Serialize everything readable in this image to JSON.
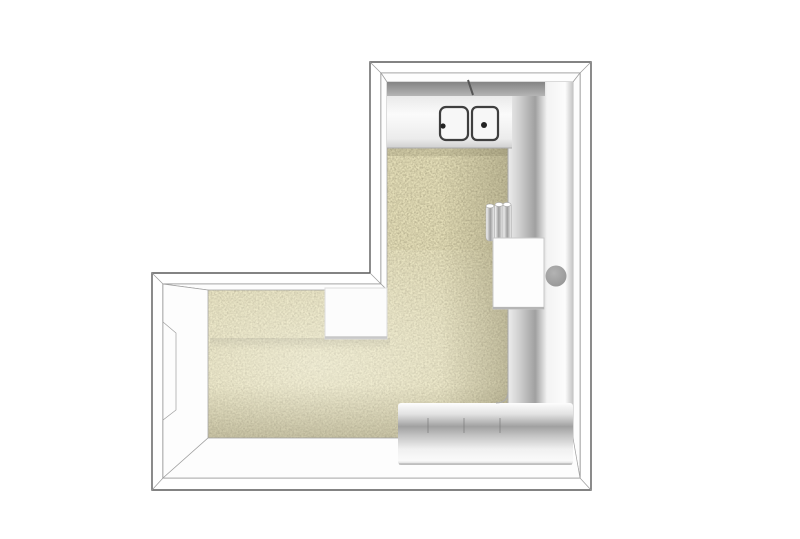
{
  "meta": {
    "type": "3d-floorplan-top-view",
    "description": "Top-down 3D rendering of an L-shaped kitchen floor plan with counters, double sink and appliances",
    "room_shape": "L-shaped",
    "text_content": "none"
  },
  "colors": {
    "background": "#ffffff",
    "wall_fill": "#ffffff",
    "wall_line": "#5a5a5a",
    "face_fill": "#fdfdfd",
    "floor_base": "#e4deb8",
    "floor_speckle": "#6f6850",
    "backsplash_dark": "#848484",
    "backsplash_light": "#b5b5b5",
    "counter_light": "#fbfbfb",
    "counter_mid": "#a0a0a0",
    "counter_edge": "#cfcfcf",
    "sink_fill": "#f7f7f7",
    "sink_line": "#3f3f3f",
    "drain_dot": "#222222",
    "appliance_fill": "#fdfdfd",
    "appliance_edge": "#c0c0c0",
    "knob_fill": "#939393",
    "table_fill": "#fcfcfc",
    "table_edge": "#cccccc",
    "pipe_mid": "#9e9e9e"
  },
  "elements": {
    "walls": "L-shaped perimeter wall with perspective inner faces",
    "door_opening": "opening in left wall of lower wing",
    "top_counter": "kitchen counter along top wall",
    "sink": {
      "basins": 2,
      "drain_dots": 2,
      "faucet_mark": 1
    },
    "right_counter": "full-height counter run along right wall",
    "bottom_counter": "counter run along bottom wall with cabinet divisions",
    "cabinet_divisions": 3,
    "standpipes": 3,
    "appliance_box": "white appliance recessed into right counter",
    "round_fixture": "grey circular knob on right counter",
    "side_table": "white square table at inner corner",
    "floor": "beige speckled screed floor"
  }
}
